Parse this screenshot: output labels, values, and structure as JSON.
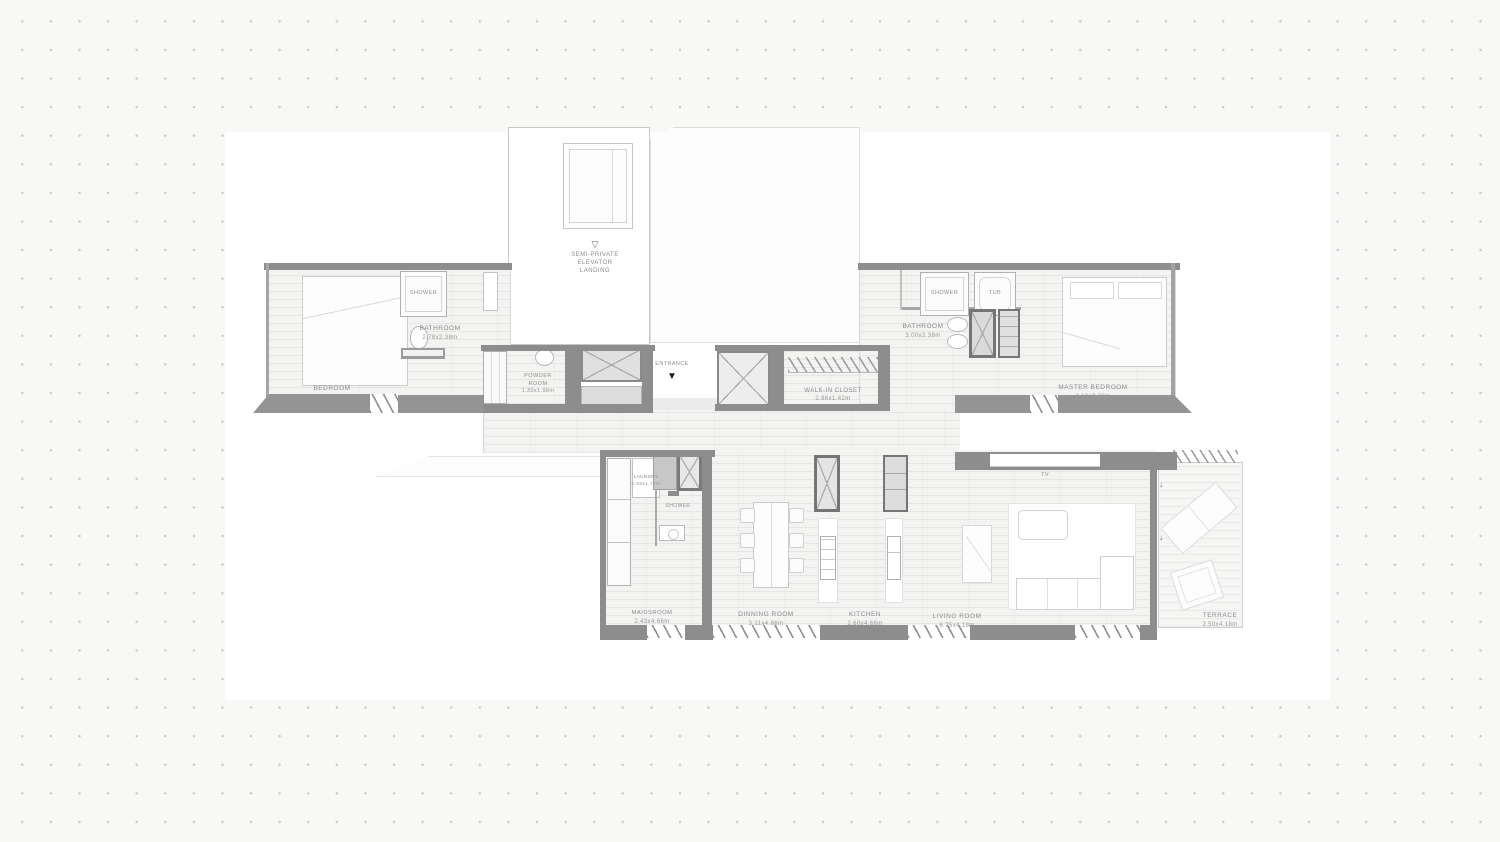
{
  "colors": {
    "wall": "#8d8d8d",
    "ledge": "#949494",
    "dot_grid": "#c9c9c9",
    "floor": "#f3f3f2",
    "label_text": "#8b8b8b"
  },
  "elevator": {
    "arrow": "▽",
    "label": "SEMI-PRIVATE\nELEVATOR\nLANDING"
  },
  "entrance": {
    "label": "ENTRANCE",
    "arrow": "▼"
  },
  "terrace_door_arrow": "↓",
  "rooms": {
    "bedroom": {
      "name": "BEDROOM",
      "dims": "3.53x3.28m"
    },
    "bathroom_left": {
      "name": "BATHROOM",
      "dims": "2.78x2.38m"
    },
    "shower_left": {
      "name": "SHOWER"
    },
    "powder_room": {
      "name": "POWDER\nROOM",
      "dims": "1.30x1.98m"
    },
    "walkin_closet": {
      "name": "WALK-IN  CLOSET",
      "dims": "2.86x1.42m"
    },
    "bathroom_right": {
      "name": "BATHROOM",
      "dims": "3.00x2.38m"
    },
    "shower_right": {
      "name": "SHOWER"
    },
    "tub": {
      "name": "TUB"
    },
    "master_bedroom": {
      "name": "MASTER  BEDROOM",
      "dims": "4.10x3.28m"
    },
    "laundry": {
      "name": "LAUNDRY",
      "dims": "0.88x1.77m"
    },
    "shower_maid": {
      "name": "SHOWER"
    },
    "maidsroom": {
      "name": "MAIDSROOM",
      "dims": "2.43x4.66m"
    },
    "dinning_room": {
      "name": "DINNING  ROOM",
      "dims": "3.11x4.66m"
    },
    "kitchen": {
      "name": "KITCHEN",
      "dims": "2.60x4.66m"
    },
    "living_room": {
      "name": "LIVING  ROOM",
      "dims": "6.75x4.18m"
    },
    "terrace": {
      "name": "TERRACE",
      "dims": "2.50x4.18m"
    },
    "tv": {
      "name": "TV"
    }
  }
}
